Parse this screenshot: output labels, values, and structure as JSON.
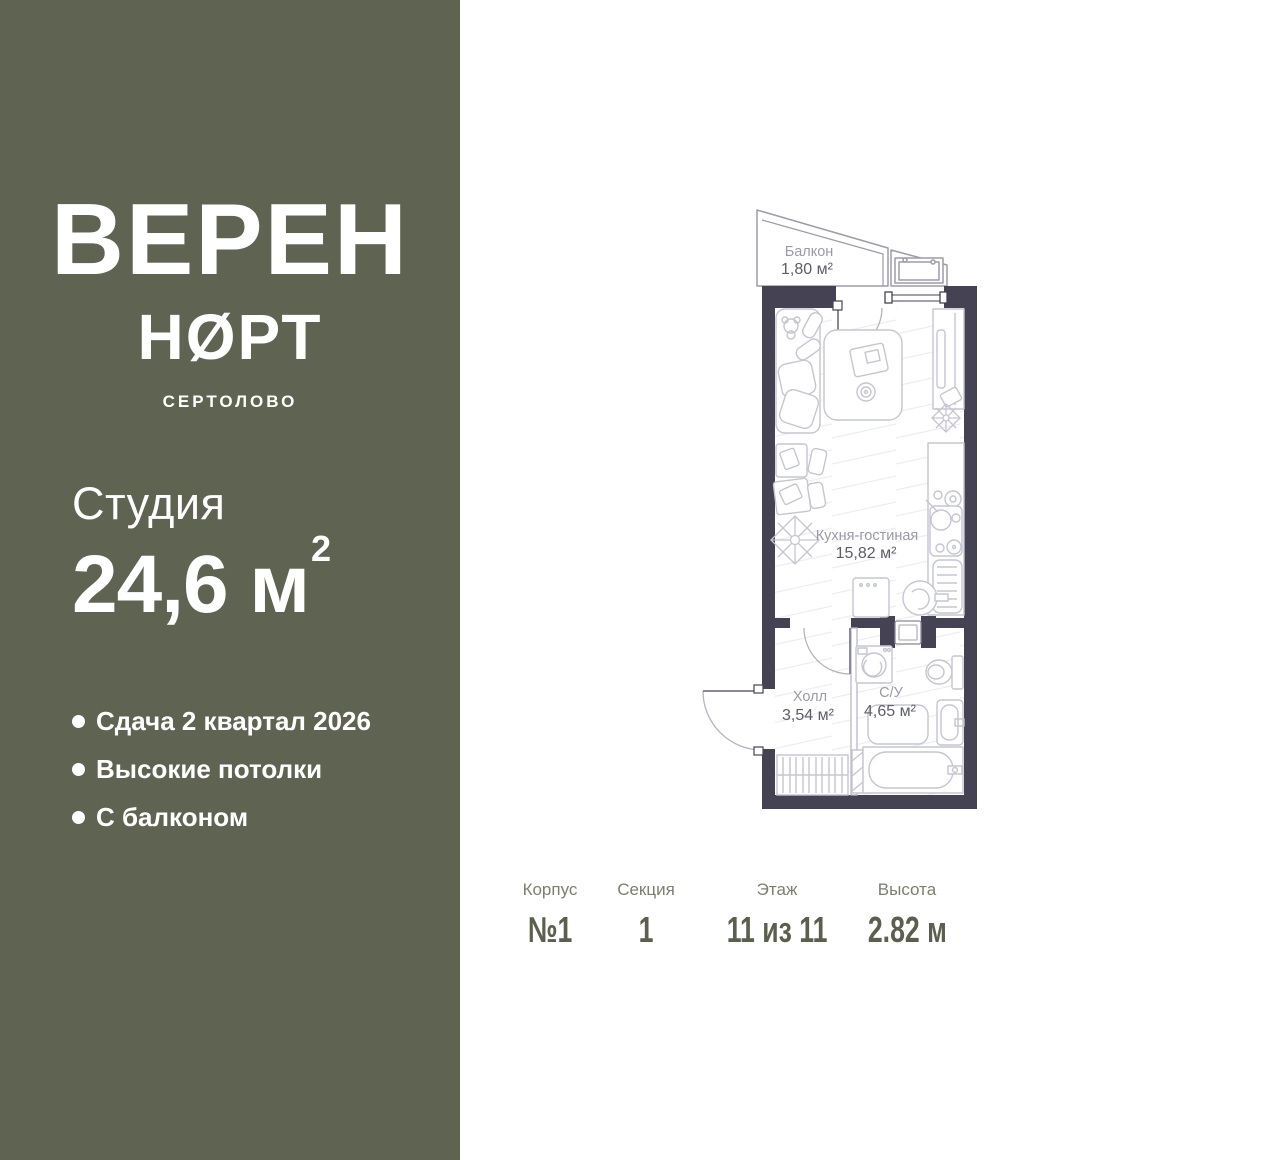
{
  "sidebar": {
    "logo_line1": "ВЕРЕН",
    "logo_line2": "НØРТ",
    "logo_city": "СЕРТОЛОВО",
    "unit_type": "Студия",
    "area_value": "24,6 м",
    "area_sup": "2",
    "features": [
      "Сдача 2 квартал 2026",
      "Высокие потолки",
      "С балконом"
    ]
  },
  "plan": {
    "rooms": [
      {
        "name": "Балкон",
        "area": "1,80 м²"
      },
      {
        "name": "Кухня-гостиная",
        "area": "15,82 м²"
      },
      {
        "name": "Холл",
        "area": "3,54 м²"
      },
      {
        "name": "С/У",
        "area": "4,65 м²"
      }
    ]
  },
  "info": {
    "columns": [
      {
        "label": "Корпус",
        "value": "№1"
      },
      {
        "label": "Секция",
        "value": "1"
      },
      {
        "label": "Этаж",
        "value": "11 из 11"
      },
      {
        "label": "Высота",
        "value": "2.82 м"
      }
    ]
  },
  "colors": {
    "sidebar_bg": "#5f6452",
    "wall": "#454253",
    "furniture_line": "#c6c5d2",
    "plan_label": "#9b99a6",
    "plan_area_text": "#5e5c6a",
    "info_label": "#7b7f6e",
    "info_value": "#5b5f4d"
  }
}
